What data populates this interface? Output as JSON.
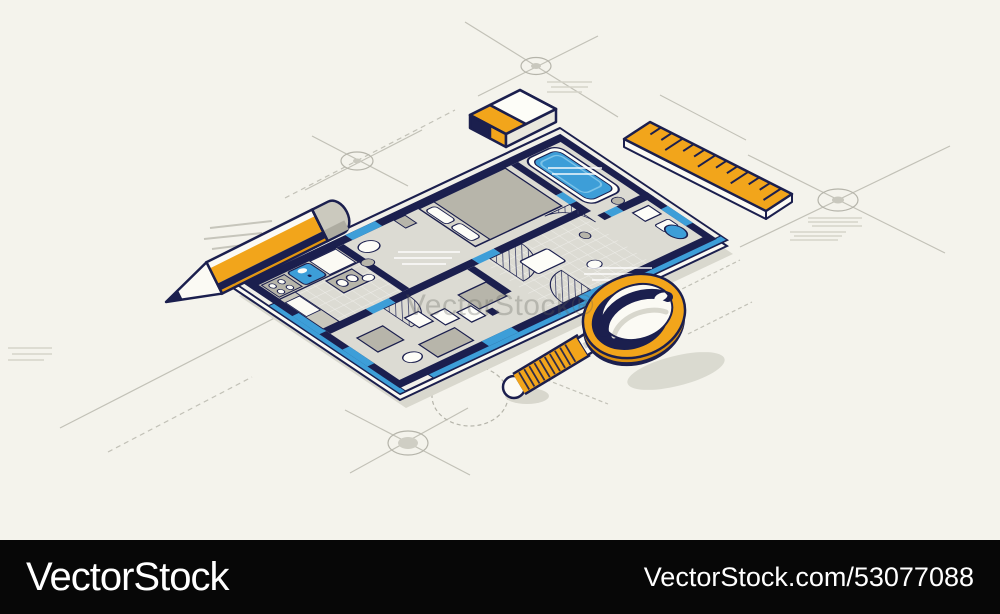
{
  "page": {
    "background_color": "#F4F3EC",
    "width": 1000,
    "height": 614
  },
  "watermark": {
    "text": "VectorStock®"
  },
  "footer": {
    "logo_text": "VectorStock",
    "credit_text": "VectorStock.com/53077088",
    "bar_color": "#070707",
    "text_color": "#FFFFFF"
  },
  "illustration": {
    "description": "Isometric apartment floor plan blueprint with pencil, eraser, ruler, magnifying glass and drafting construction marks",
    "colors": {
      "accent_orange": "#F2A51B",
      "outline_navy": "#1B1F4E",
      "fixture_blue": "#3D9ED8",
      "slab_white": "#F1F0E9",
      "floor_gray": "#DCDBD3",
      "furniture_gray": "#B7B5AA",
      "counter_gray": "#C9C7BC",
      "paper_white": "#FBFAF4",
      "construction_line_gray": "#C2C1B7",
      "shadow_gray": "#D9D8CE"
    },
    "objects": [
      {
        "name": "floor-plan"
      },
      {
        "name": "pencil"
      },
      {
        "name": "eraser"
      },
      {
        "name": "ruler"
      },
      {
        "name": "magnifying-glass"
      },
      {
        "name": "crosshair-targets"
      }
    ]
  }
}
